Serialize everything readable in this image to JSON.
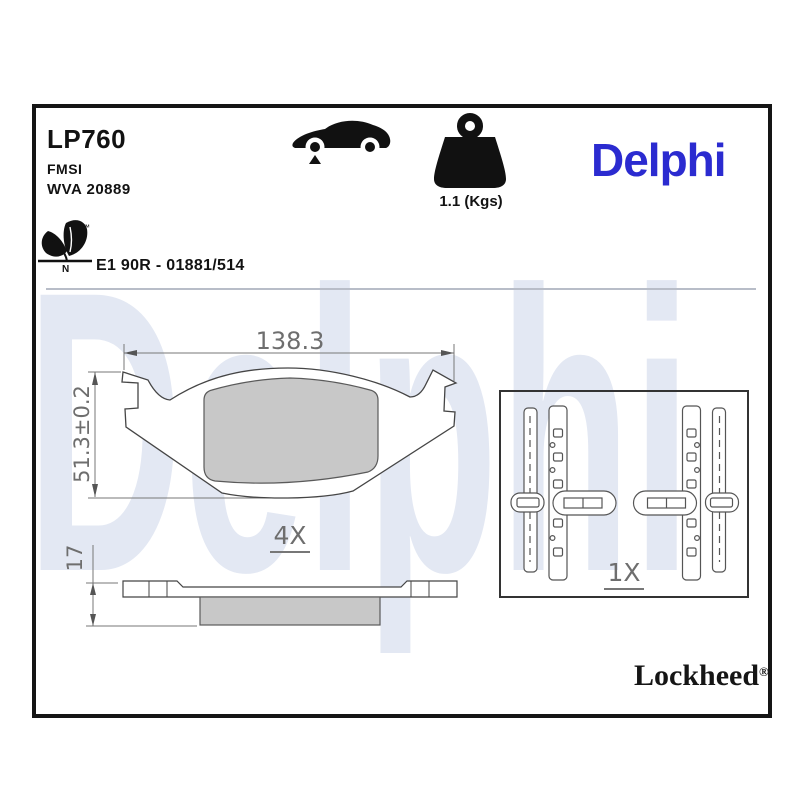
{
  "header": {
    "sku": "LP760",
    "standard": "FMSI",
    "wva_number": "WVA 20889",
    "weight_label": "1.1 (Kgs)",
    "homologation": "E1 90R - 01881/514",
    "eco_mark_letter": "N",
    "trademark_symbol": "™"
  },
  "brand": {
    "logo_text": "Delphi",
    "watermark_text": "Delphi",
    "footer_brand": "Lockheed",
    "registered_symbol": "®",
    "logo_color": "#2b2bd0",
    "watermark_color": "#e3e8f3"
  },
  "dimensions": {
    "pad_width": "138.3",
    "pad_height": "51.3±0.2",
    "pad_thickness": "17",
    "pad_piece_count": "4X",
    "kit_piece_count": "1X"
  },
  "colors": {
    "friction_fill": "#c8c8c8",
    "outline_color": "#454545",
    "dimension_color": "#6e6e6e",
    "frame_border": "#151515"
  }
}
